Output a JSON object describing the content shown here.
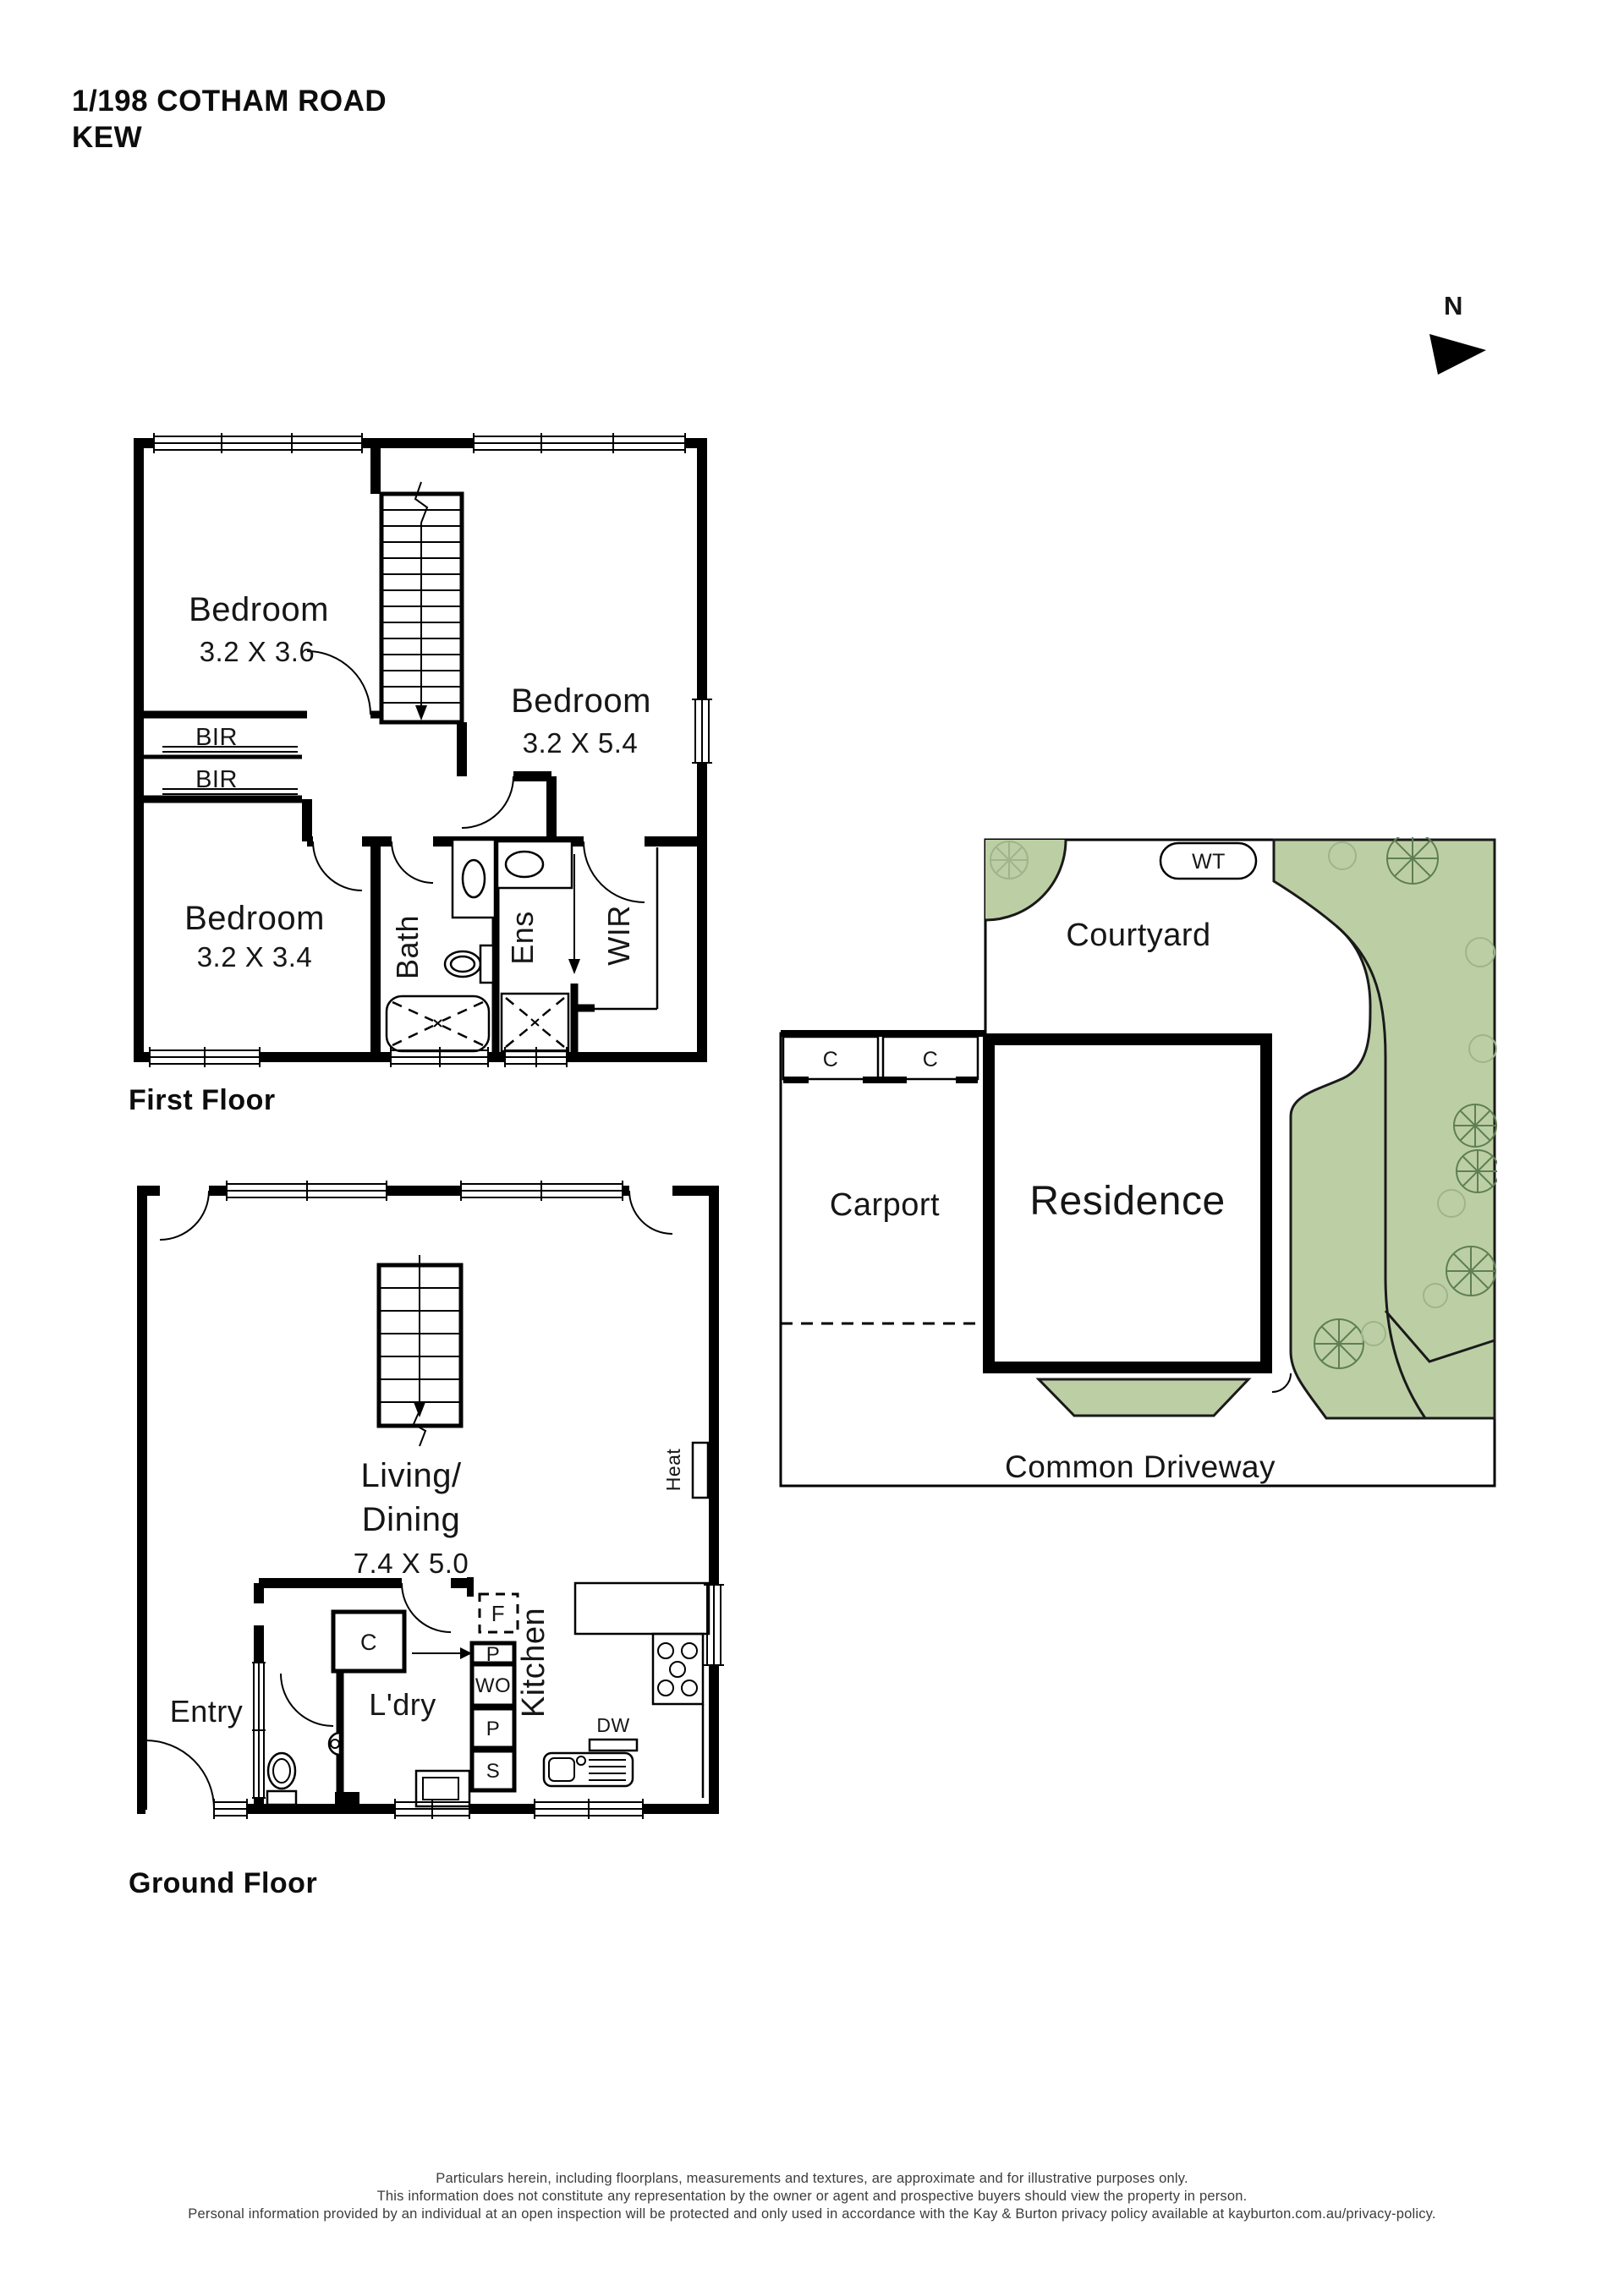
{
  "header": {
    "address_line1": "1/198 COTHAM ROAD",
    "address_line2": "KEW"
  },
  "north": {
    "label": "N"
  },
  "first_floor": {
    "title": "First Floor",
    "bedroom1": {
      "name": "Bedroom",
      "dims": "3.2 X 3.6"
    },
    "bedroom2": {
      "name": "Bedroom",
      "dims": "3.2 X 5.4"
    },
    "bedroom3": {
      "name": "Bedroom",
      "dims": "3.2 X 3.4"
    },
    "bir1": "BIR",
    "bir2": "BIR",
    "bath": "Bath",
    "ens": "Ens",
    "wir": "WIR"
  },
  "ground_floor": {
    "title": "Ground Floor",
    "living": {
      "line1": "Living/",
      "line2": "Dining",
      "dims": "7.4 X 5.0"
    },
    "entry": "Entry",
    "laundry": "L'dry",
    "kitchen": "Kitchen",
    "closet": "C",
    "heat": "Heat",
    "fridge": "F",
    "pantry_upper": "P",
    "wall_oven": "WO",
    "pantry_lower": "P",
    "sink": "S",
    "dishwasher": "DW"
  },
  "site": {
    "courtyard": "Courtyard",
    "carport": "Carport",
    "residence": "Residence",
    "driveway": "Common Driveway",
    "water_tank": "WT",
    "store1": "C",
    "store2": "C",
    "green_color": "#bccfa4"
  },
  "footer": {
    "line1": "Particulars herein, including floorplans, measurements and textures, are approximate and for illustrative purposes only.",
    "line2": "This information does not constitute any representation by the owner or agent and prospective buyers should view the property in person.",
    "line3": "Personal information provided by an individual at an open inspection will be protected and only used in accordance with the Kay & Burton privacy policy available at kayburton.com.au/privacy-policy."
  }
}
